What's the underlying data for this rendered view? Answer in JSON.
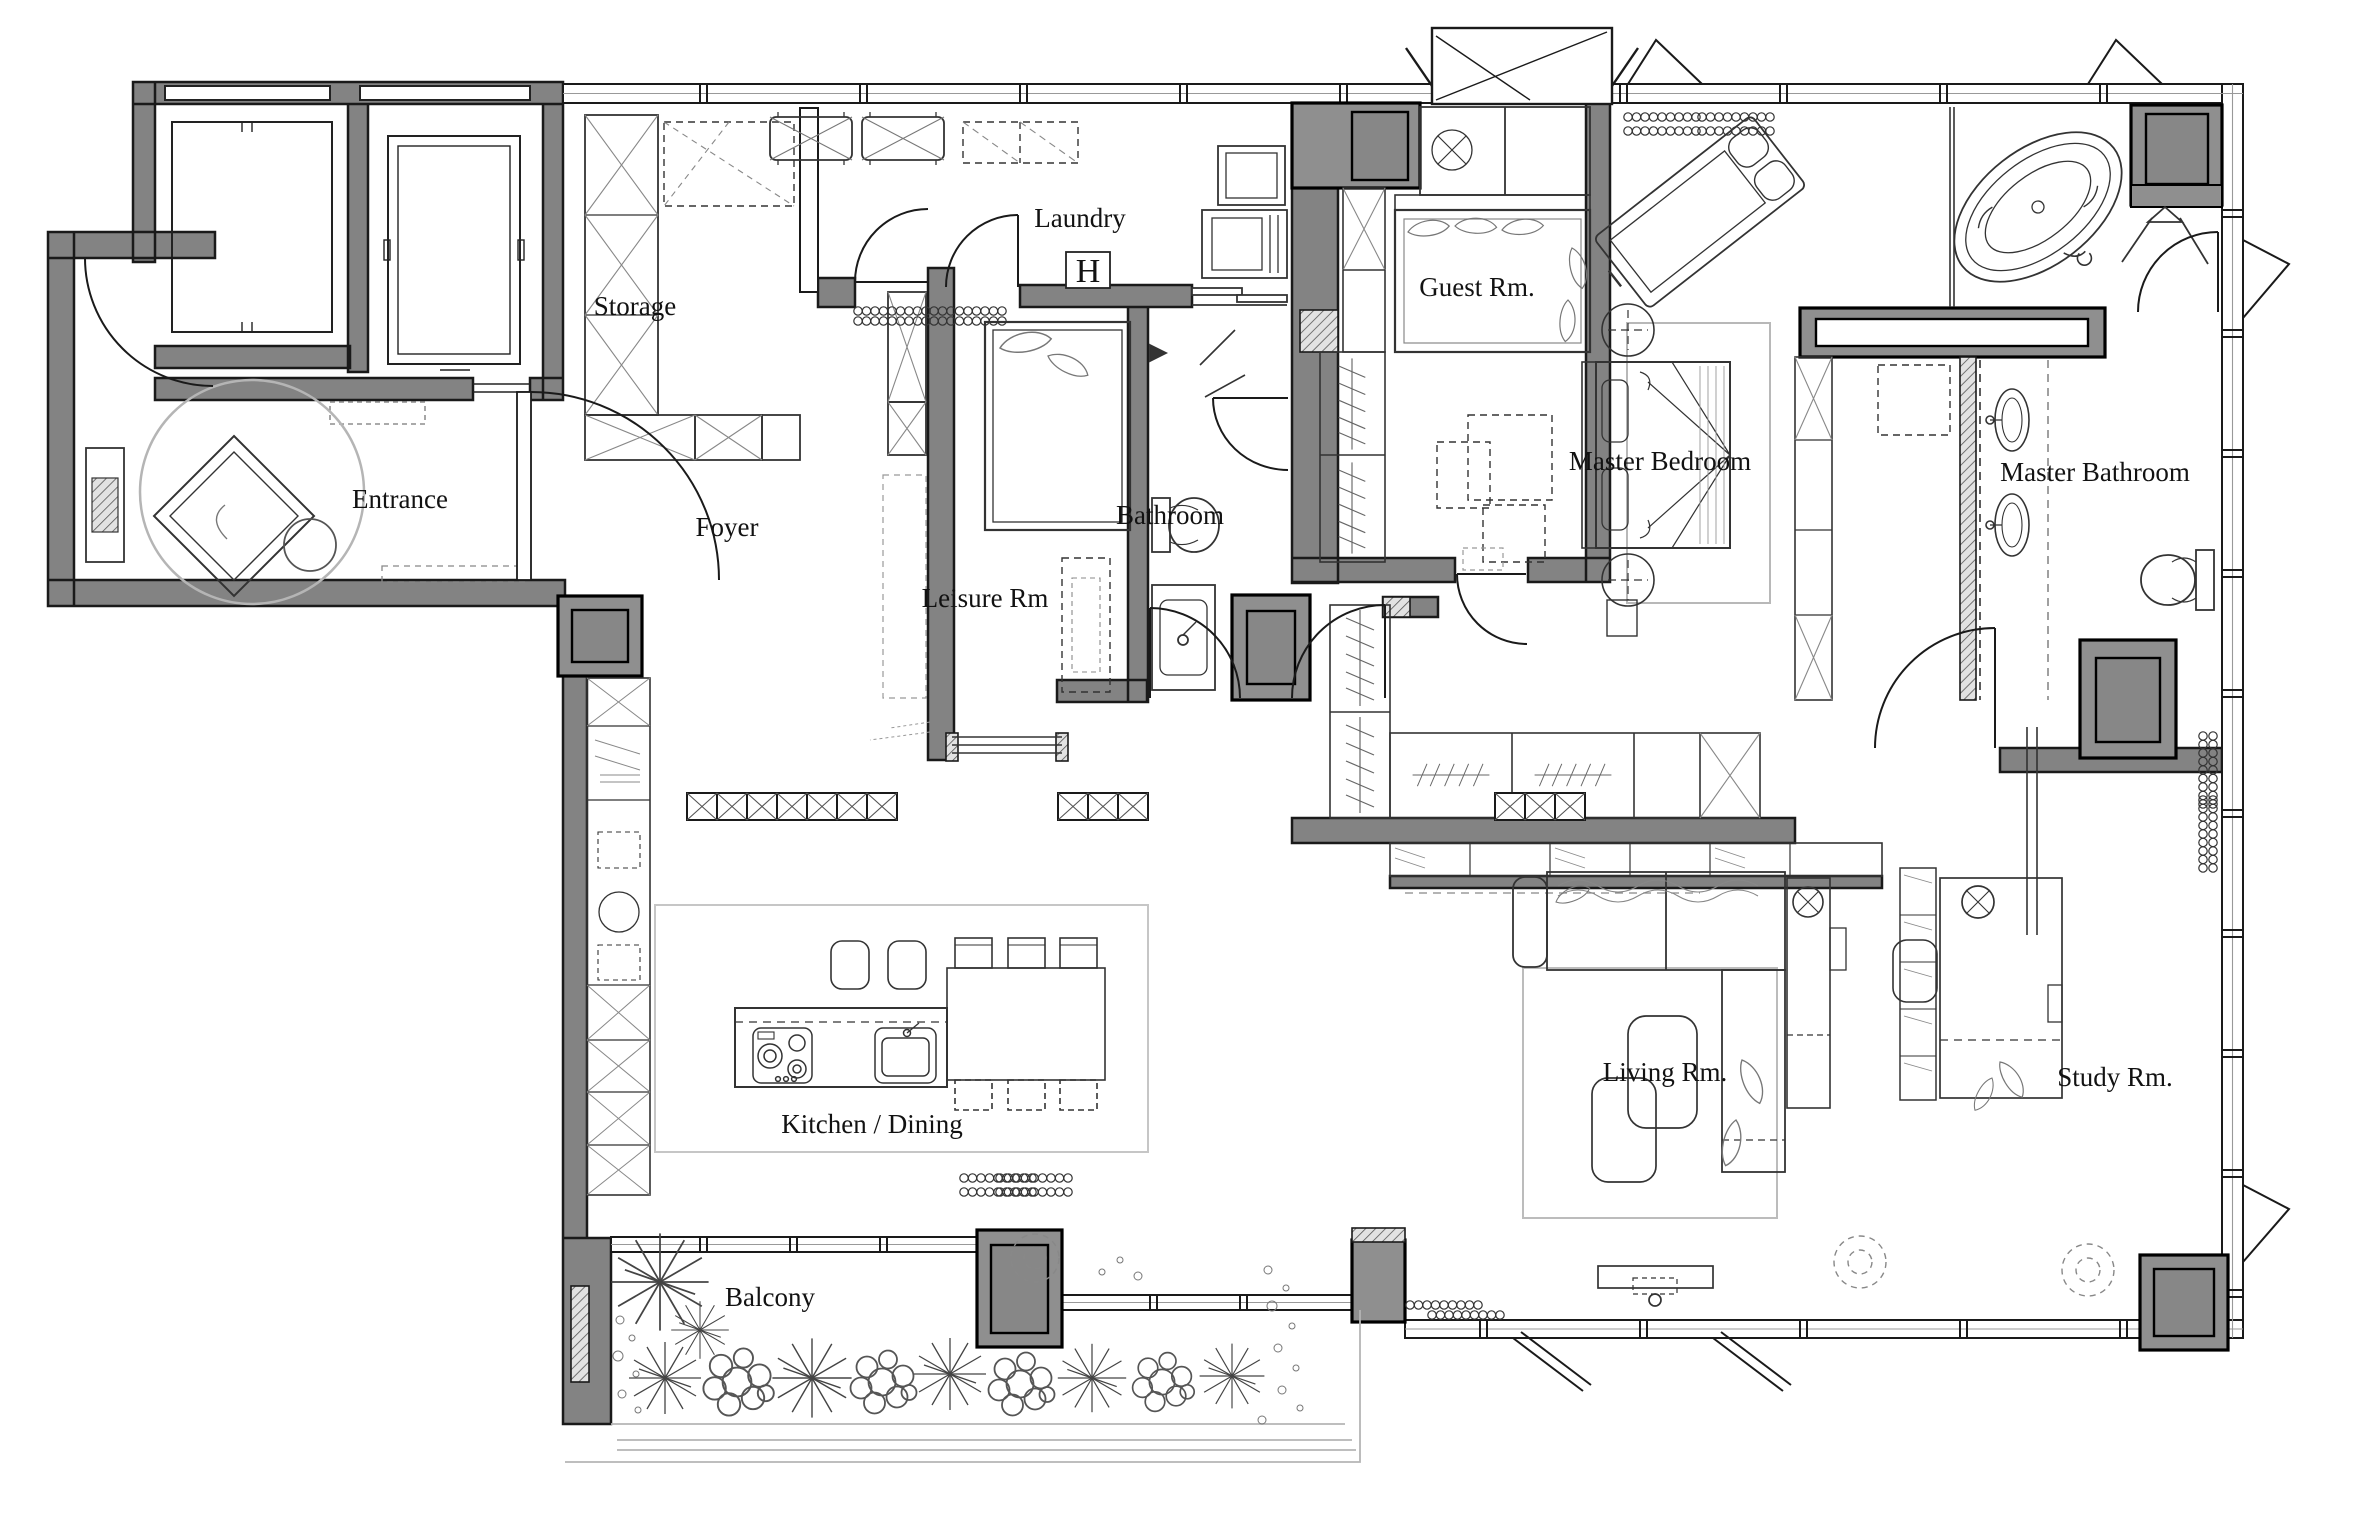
{
  "title": "Apartment Floor Plan",
  "colors": {
    "wall": "#838383",
    "column_block": "#8f8f8f",
    "block_inner": "#878787",
    "line": "#1a1a1a",
    "light_line": "#aaaaaa",
    "background": "#ffffff"
  },
  "rooms": {
    "entrance": "Entrance",
    "foyer": "Foyer",
    "storage": "Storage",
    "laundry": "Laundry",
    "laundry_symbol": "H",
    "leisure": "Leisure Rm",
    "bathroom": "Bathroom",
    "guest": "Guest Rm.",
    "master_bedroom": "Master Bedroom",
    "master_bathroom": "Master Bathroom",
    "kitchen_dining": "Kitchen / Dining",
    "living": "Living Rm.",
    "study": "Study Rm.",
    "balcony": "Balcony"
  }
}
